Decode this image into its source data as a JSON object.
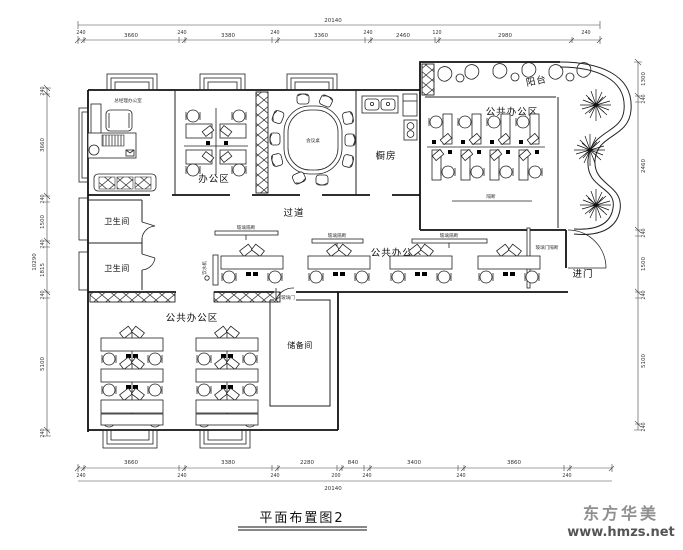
{
  "title": {
    "text": "平面布置图2"
  },
  "watermark": {
    "brand": "东方华美",
    "site": "www.hmzs.net"
  },
  "rooms": {
    "manager_note": "总经理办公室",
    "office": "办公区",
    "conference_note": "会议桌",
    "kitchen": "橱房",
    "balcony": "阳台",
    "public_office_top": "公共办公区",
    "partition_note": "隔断",
    "corridor": "过道",
    "bathroom_1": "卫生间",
    "bathroom_2": "卫生间",
    "public_office_mid": "公共办公区",
    "entrance": "进门",
    "public_office_bottom": "公共办公区",
    "storage": "储备间",
    "shelf_note_1": "玻璃隔断",
    "shelf_note_2": "玻璃隔断",
    "shelf_note_3": "玻璃隔断",
    "water_dispenser_note": "饮水机",
    "entrance_note": "玻璃门隔断",
    "storage_door_note": "玻璃门"
  },
  "dimensions": {
    "top_total": "20140",
    "top": [
      "240",
      "3660",
      "240",
      "3380",
      "240",
      "3360",
      "240",
      "2460",
      "120",
      "2980",
      "240"
    ],
    "bottom": [
      "240",
      "3660",
      "240",
      "3380",
      "240",
      "2280",
      "200",
      "840",
      "240",
      "3400",
      "240",
      "3860",
      "240"
    ],
    "bottom_total": "20140",
    "left_total": "10290",
    "left": [
      "240",
      "3660",
      "240",
      "1500",
      "240",
      "1815",
      "240",
      "5100",
      "240"
    ],
    "right": [
      "1300",
      "240",
      "2460",
      "240",
      "1500",
      "240",
      "5100",
      "240"
    ]
  },
  "colors": {
    "line": "#111111",
    "watermark": "#8f8f8f",
    "background": "#ffffff"
  }
}
